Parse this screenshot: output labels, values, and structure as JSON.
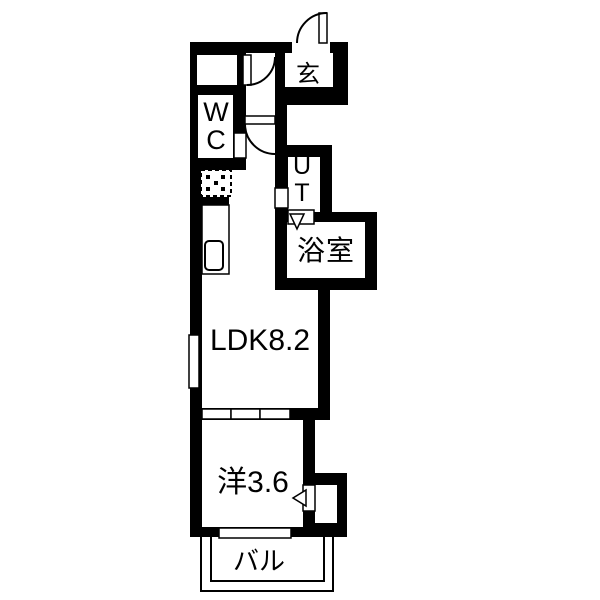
{
  "plan": {
    "type": "apartment-floor-plan",
    "colors": {
      "wall": "#000000",
      "floor": "#ffffff"
    },
    "rooms": {
      "entrance": {
        "label": "玄"
      },
      "toilet": {
        "label": "W\nC"
      },
      "utility": {
        "label": "U\nT"
      },
      "bathroom": {
        "label": "浴室"
      },
      "ldk": {
        "label": "LDK8.2"
      },
      "western_room": {
        "label": "洋3.6"
      },
      "balcony": {
        "label": "バル"
      }
    }
  }
}
